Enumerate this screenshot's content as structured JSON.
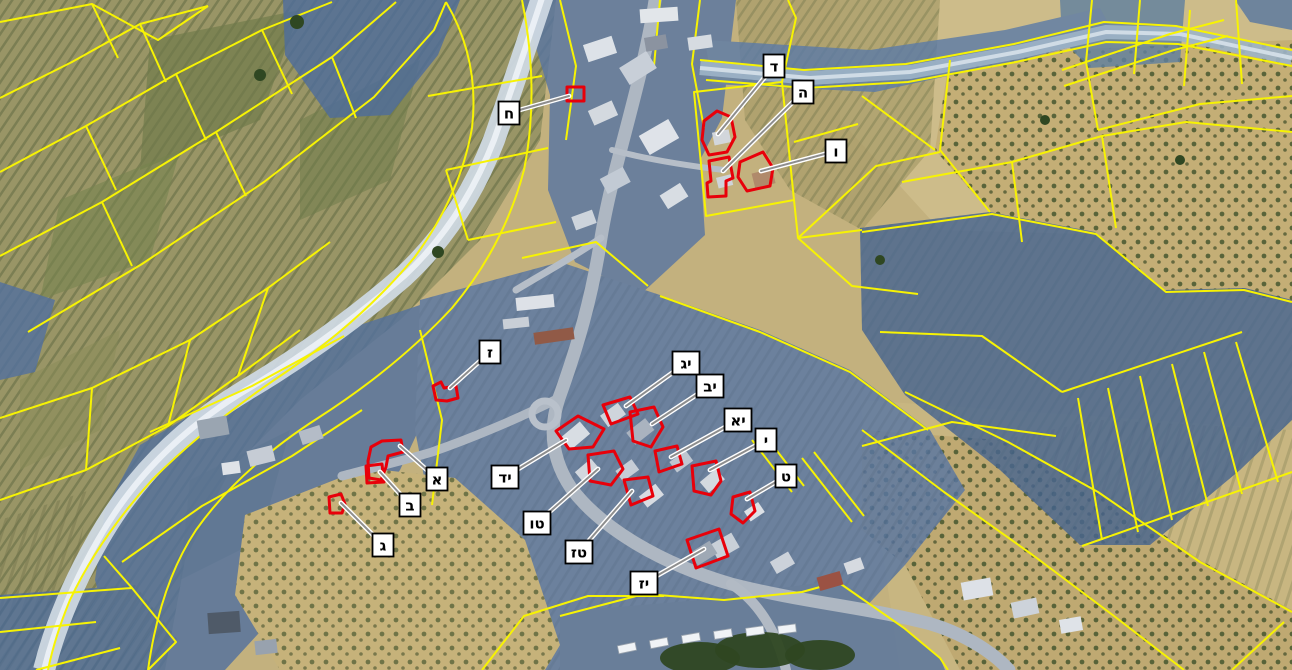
{
  "map": {
    "type": "annotated-aerial-cadastral-map",
    "canvas": {
      "width": 1292,
      "height": 670
    },
    "colors": {
      "parcel_line": "#f7f303",
      "marker_outline": "#e8000a",
      "overlay_blue": "#4f6d9c",
      "leader": "#8e8e8e",
      "label_bg": "#ffffff",
      "label_border": "#000000",
      "label_text": "#000000",
      "wadi_light": "#cdd8e2",
      "terrain_tan": "#c3b17e",
      "terrain_olive": "#999566"
    },
    "labels": [
      {
        "id": "alef",
        "letter": "א",
        "box": {
          "x": 437,
          "y": 479
        },
        "target": {
          "x": 400,
          "y": 446
        },
        "shape": "368,461 371,447 382,441 401,440 403,452 388,456 386,467 381,480 369,478"
      },
      {
        "id": "bet",
        "letter": "ב",
        "box": {
          "x": 410,
          "y": 505
        },
        "target": {
          "x": 380,
          "y": 472
        },
        "shape": "366,466 382,464 384,482 367,483"
      },
      {
        "id": "gimel",
        "letter": "ג",
        "box": {
          "x": 383,
          "y": 545
        },
        "target": {
          "x": 341,
          "y": 503
        },
        "shape": "329,497 341,494 345,504 342,513 330,513"
      },
      {
        "id": "dalet",
        "letter": "ד",
        "box": {
          "x": 774,
          "y": 66
        },
        "target": {
          "x": 718,
          "y": 134
        },
        "shape": "704,121 717,111 731,117 735,137 727,152 709,155 702,140"
      },
      {
        "id": "he",
        "letter": "ה",
        "box": {
          "x": 803,
          "y": 92
        },
        "target": {
          "x": 723,
          "y": 171
        },
        "shape": "709,161 729,157 733,178 726,181 726,196 708,197 707,183 711,181"
      },
      {
        "id": "vav",
        "letter": "ו",
        "box": {
          "x": 836,
          "y": 151
        },
        "target": {
          "x": 761,
          "y": 171
        },
        "shape": "740,162 763,152 773,168 770,186 747,191 738,177"
      },
      {
        "id": "zayin",
        "letter": "ז",
        "box": {
          "x": 490,
          "y": 352
        },
        "target": {
          "x": 450,
          "y": 388
        },
        "shape": "433,386 441,382 444,388 456,386 458,398 447,401 436,400"
      },
      {
        "id": "het",
        "letter": "ח",
        "box": {
          "x": 509,
          "y": 113
        },
        "target": {
          "x": 569,
          "y": 96
        },
        "shape": "567,87 584,87 584,101 567,101"
      },
      {
        "id": "tet",
        "letter": "ט",
        "box": {
          "x": 786,
          "y": 476
        },
        "target": {
          "x": 747,
          "y": 499
        },
        "shape": "733,497 750,492 755,511 743,523 731,514"
      },
      {
        "id": "yod",
        "letter": "י",
        "box": {
          "x": 766,
          "y": 440
        },
        "target": {
          "x": 710,
          "y": 470
        },
        "shape": "692,466 716,461 721,481 711,495 694,491"
      },
      {
        "id": "yod-alef",
        "letter": "יא",
        "box": {
          "x": 738,
          "y": 420
        },
        "target": {
          "x": 671,
          "y": 457
        },
        "shape": "655,451 677,446 682,464 659,472"
      },
      {
        "id": "yod-bet",
        "letter": "יב",
        "box": {
          "x": 710,
          "y": 386
        },
        "target": {
          "x": 652,
          "y": 424
        },
        "shape": "630,412 654,407 663,427 651,447 633,441"
      },
      {
        "id": "yod-gimel",
        "letter": "יג",
        "box": {
          "x": 686,
          "y": 363
        },
        "target": {
          "x": 626,
          "y": 406
        },
        "shape": "603,405 630,397 638,414 611,424"
      },
      {
        "id": "yod-dalet",
        "letter": "יד",
        "box": {
          "x": 505,
          "y": 477
        },
        "target": {
          "x": 566,
          "y": 440
        },
        "shape": "556,431 578,416 604,429 593,447 569,449"
      },
      {
        "id": "tet-vav",
        "letter": "טו",
        "box": {
          "x": 537,
          "y": 523
        },
        "target": {
          "x": 598,
          "y": 469
        },
        "shape": "588,455 614,451 623,469 611,485 590,481"
      },
      {
        "id": "tet-zayin",
        "letter": "טז",
        "box": {
          "x": 579,
          "y": 552
        },
        "target": {
          "x": 632,
          "y": 491
        },
        "shape": "624,480 648,477 653,496 631,505"
      },
      {
        "id": "yod-zayin",
        "letter": "יז",
        "box": {
          "x": 644,
          "y": 583
        },
        "target": {
          "x": 704,
          "y": 549
        },
        "shape": "687,540 719,529 728,556 696,568"
      }
    ]
  }
}
